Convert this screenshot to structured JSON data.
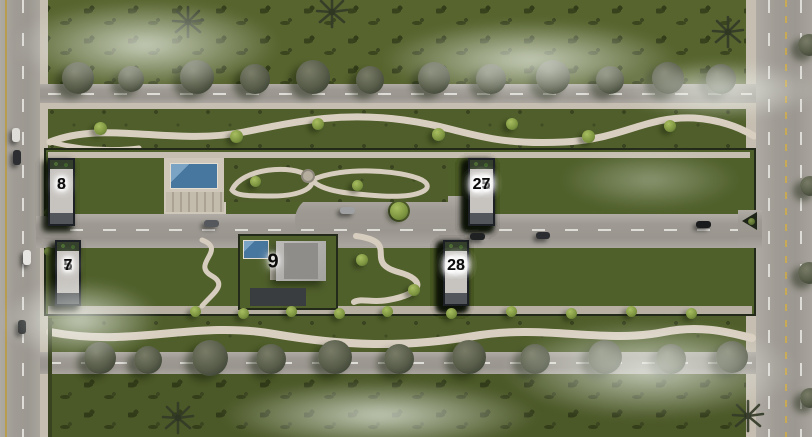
{
  "units": {
    "row_top_left": [
      "2",
      "4",
      "6",
      "8"
    ],
    "row_top_right": [
      "11",
      "13",
      "15",
      "17",
      "19",
      "21",
      "23",
      "25",
      "27"
    ],
    "row_bottom_left": [
      "1",
      "3",
      "5",
      "7"
    ],
    "center": "9",
    "row_bottom_right": [
      "10",
      "12",
      "14",
      "16",
      "18",
      "20",
      "22",
      "24",
      "26",
      "28"
    ]
  },
  "colors": {
    "grass_field": "#57642e",
    "grass_belt": "#4f5e2a",
    "road": "#a3a099",
    "path": "#d9cfc1",
    "pool_water": "#47769e",
    "villa_frame": "#1d2125",
    "villa_roof": "#c7c4c0",
    "unit_number": "#0c0c0c",
    "lane_yellow": "#c9aa54"
  }
}
